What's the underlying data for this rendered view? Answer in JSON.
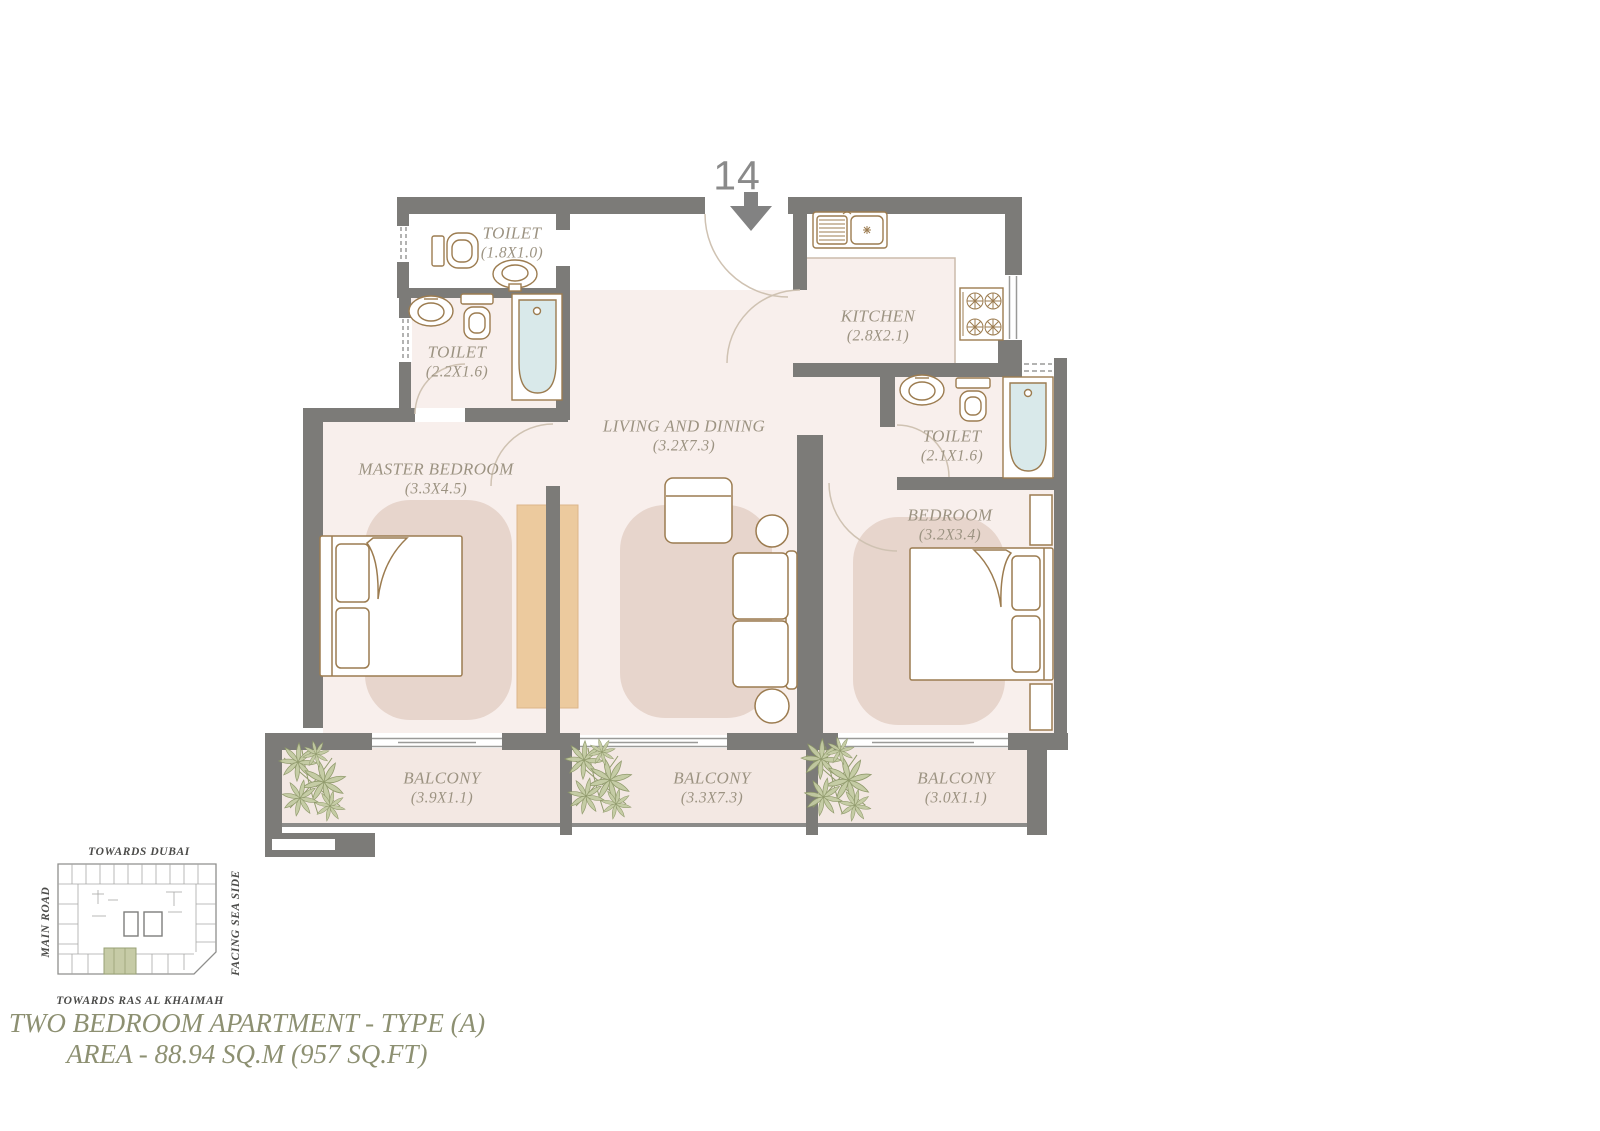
{
  "unit": {
    "number": "14"
  },
  "rooms": [
    {
      "id": "toilet-small",
      "name": "TOILET",
      "dims": "(1.8X1.0)"
    },
    {
      "id": "toilet-master",
      "name": "TOILET",
      "dims": "(2.2X1.6)"
    },
    {
      "id": "kitchen",
      "name": "KITCHEN",
      "dims": "(2.8X2.1)"
    },
    {
      "id": "living-dining",
      "name": "LIVING AND DINING",
      "dims": "(3.2X7.3)"
    },
    {
      "id": "master-bedroom",
      "name": "MASTER BEDROOM",
      "dims": "(3.3X4.5)"
    },
    {
      "id": "toilet-bedroom",
      "name": "TOILET",
      "dims": "(2.1X1.6)"
    },
    {
      "id": "bedroom",
      "name": "BEDROOM",
      "dims": "(3.2X3.4)"
    },
    {
      "id": "balcony-master",
      "name": "BALCONY",
      "dims": "(3.9X1.1)"
    },
    {
      "id": "balcony-living",
      "name": "BALCONY",
      "dims": "(3.3X7.3)"
    },
    {
      "id": "balcony-bedroom",
      "name": "BALCONY",
      "dims": "(3.0X1.1)"
    }
  ],
  "site_map": {
    "top_label": "TOWARDS DUBAI",
    "left_label": "MAIN ROAD",
    "right_label": "FACING SEA SIDE",
    "bottom_label": "TOWARDS RAS AL KHAIMAH"
  },
  "title": {
    "line1": "TWO BEDROOM APARTMENT - TYPE (A)",
    "line2": "AREA - 88.94 SQ.M (957 SQ.FT)"
  },
  "colors": {
    "wall": "#7c7b78",
    "floor": "#f8efec",
    "balcony_floor": "#f3e8e3",
    "rug": "#e7d5cc",
    "wardrobe": "#ecca9e",
    "fixture_outline": "#9c7c50",
    "tub_water": "#d9e9ea",
    "plant": "#c3cba2",
    "room_label_text": "#9c9382",
    "title_text": "#8d9072",
    "highlight_unit": "#c6cba6",
    "unit_number_text": "#8a8a8a"
  }
}
